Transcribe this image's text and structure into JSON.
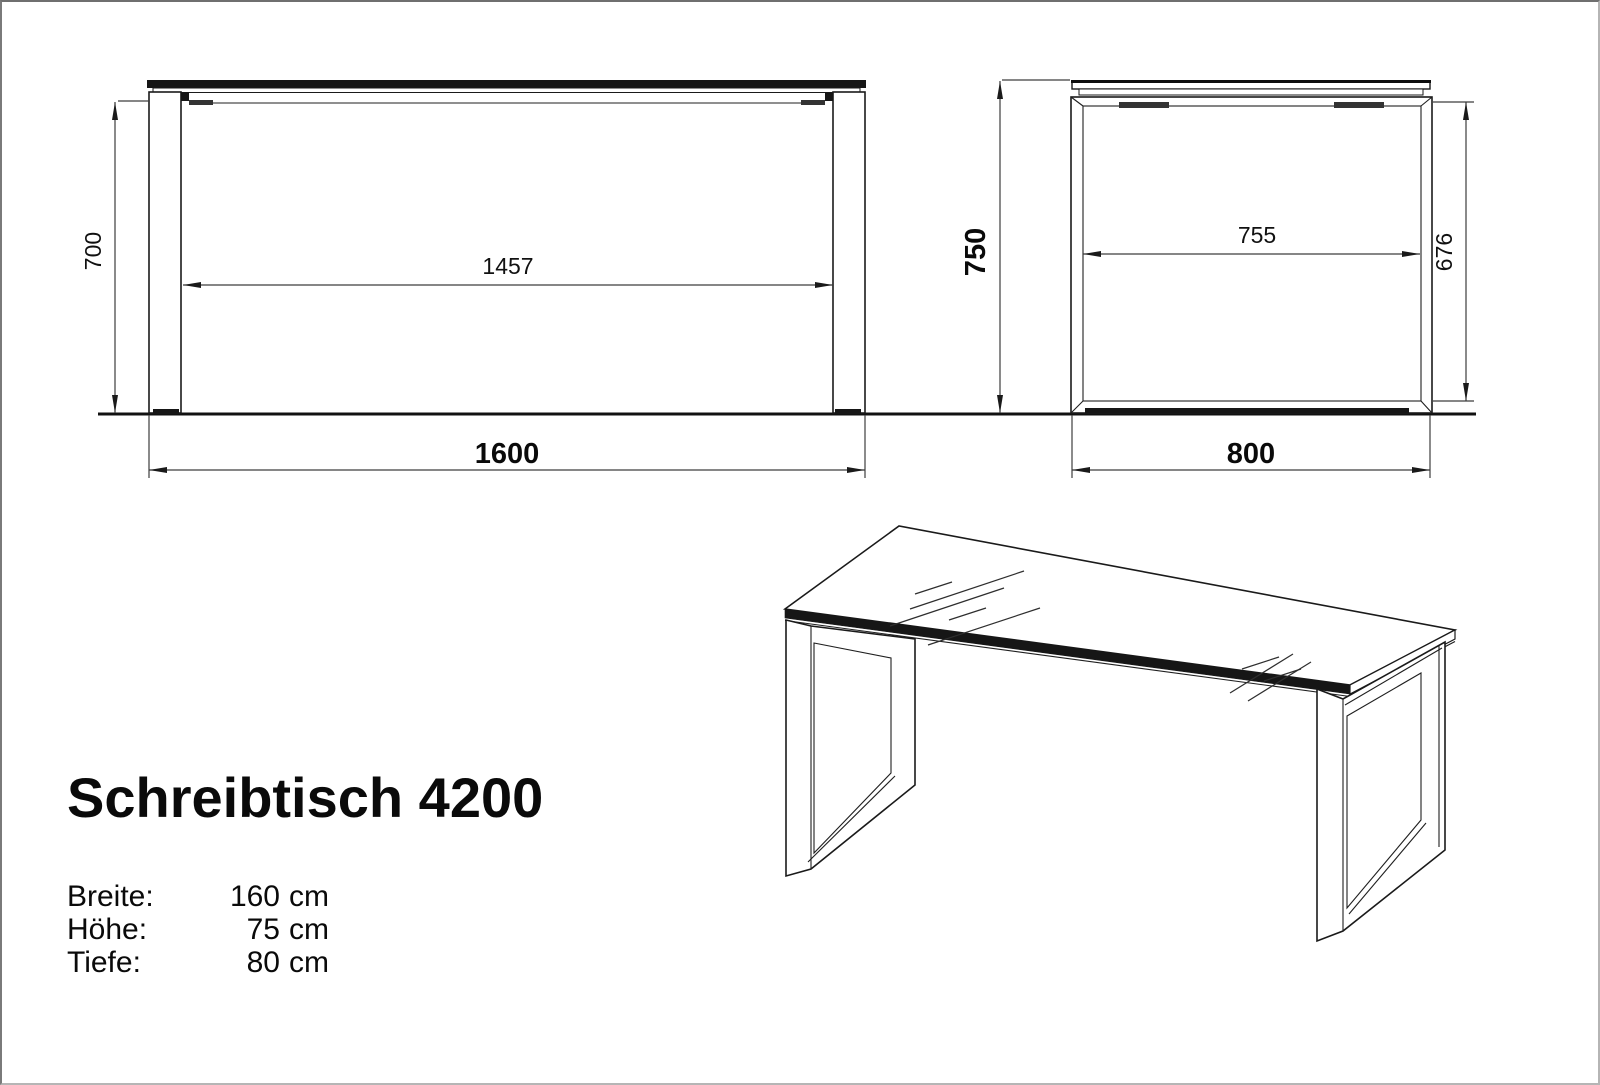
{
  "sheet": {
    "background": "#ffffff",
    "line_color": "#1a1a1a",
    "dim_line_color": "#3d3d3d"
  },
  "views": {
    "front": {
      "name": "front-elevation"
    },
    "side": {
      "name": "side-elevation"
    },
    "perspective": {
      "name": "perspective-view"
    }
  },
  "dimensions": {
    "front_leg_height": "700",
    "front_inner_width": "1457",
    "front_total_width": "1600",
    "side_total_height": "750",
    "side_inner_depth": "755",
    "side_inner_height": "676",
    "side_total_depth": "800"
  },
  "title_block": {
    "product_name": "Schreibtisch 4200",
    "specs": [
      {
        "label": "Breite:",
        "value": "160",
        "unit": "cm"
      },
      {
        "label": "Höhe:",
        "value": "75",
        "unit": "cm"
      },
      {
        "label": "Tiefe:",
        "value": "80",
        "unit": "cm"
      }
    ]
  }
}
